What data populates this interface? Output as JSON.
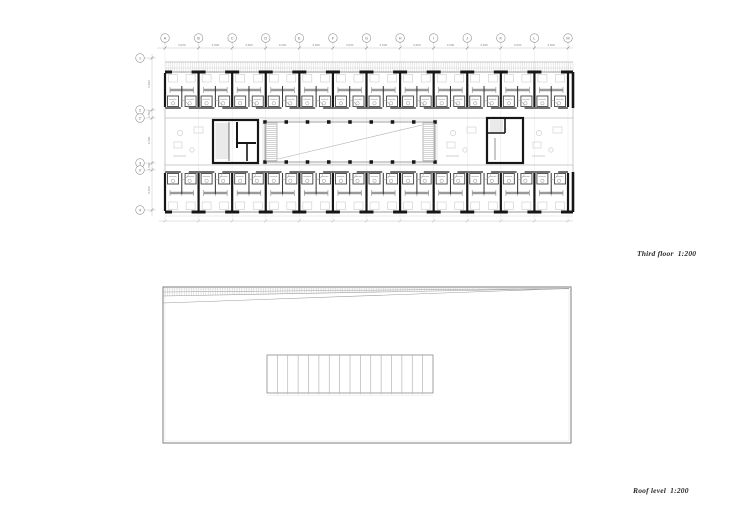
{
  "sheet": {
    "background": "#ffffff",
    "width": 730,
    "height": 516
  },
  "colors": {
    "wall": "#161616",
    "medium": "#4a4a4a",
    "thin": "#909090",
    "light": "#c6c6c6",
    "hatch": "#b9b9b9",
    "gridline": "#e7e7e7",
    "dim_text": "#8a8a8a",
    "label_text": "#2b2b2b"
  },
  "third_floor": {
    "scale_label": "Third floor  1:200",
    "grid": {
      "top_letters": [
        "A",
        "B",
        "C",
        "D",
        "E",
        "F",
        "G",
        "H",
        "I",
        "J",
        "K",
        "L",
        "M"
      ],
      "left_labels": [
        "1",
        "2",
        "2'",
        "3",
        "3'",
        "4"
      ],
      "bay_dimension": "3,600",
      "left_dimensions": [
        "5,400",
        "1,500",
        "6,600",
        "1,500",
        "5,400"
      ]
    },
    "geometry": {
      "bx0": 165,
      "bx1": 573,
      "grid_y": 38,
      "dim_y": 48,
      "grid_x0": 165,
      "grid_x_end": 568,
      "bays": 12,
      "balcony_y0": 62,
      "balcony_y1": 72,
      "top_wing": {
        "y0": 72,
        "y1": 108
      },
      "mid": {
        "y0": 118,
        "y1": 165
      },
      "bot_wing": {
        "y0": 172,
        "y1": 212
      },
      "left_grid_x": 140,
      "left_dim_x": 152,
      "left_grid_ys": [
        58,
        110,
        118,
        163,
        170,
        210
      ],
      "left_core": {
        "x0": 213,
        "y0": 120,
        "x1": 258,
        "y1": 163
      },
      "atrium": {
        "x0": 265,
        "y0": 122,
        "x1": 435,
        "y1": 162,
        "columns": 9
      },
      "right_core": {
        "x0": 487,
        "y0": 118,
        "x1": 523,
        "y1": 163
      },
      "bottom_dim_y": 221
    }
  },
  "roof": {
    "scale_label": "Roof level  1:200",
    "geometry": {
      "x0": 163,
      "y0": 287,
      "x1": 571,
      "y1": 443,
      "wedge_left_ys": [
        292,
        296,
        303
      ],
      "wedge_apex_y": 288.5,
      "skylight": {
        "x0": 267,
        "y0": 355,
        "x1": 433,
        "y1": 393,
        "cells": 16
      }
    }
  }
}
